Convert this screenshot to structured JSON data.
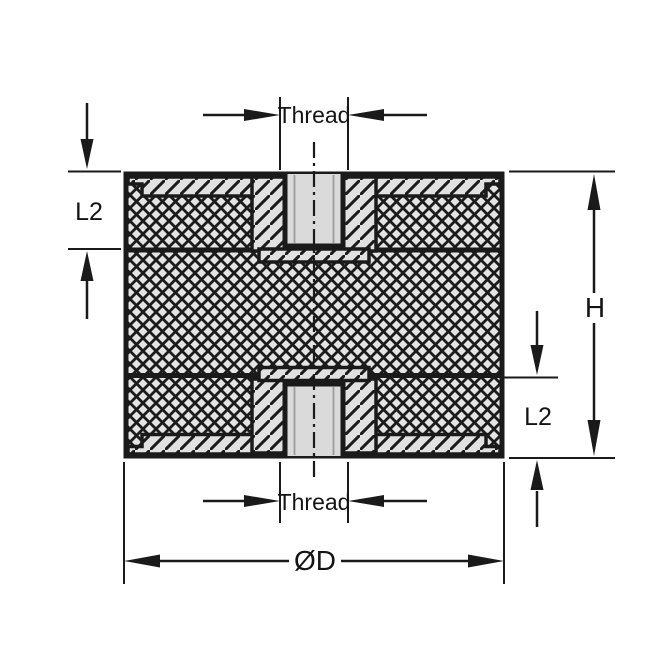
{
  "diagram": {
    "type": "technical-drawing-cross-section",
    "dimensions": [
      {
        "id": "thread-top",
        "label": "Thread"
      },
      {
        "id": "l2-left",
        "label": "L2"
      },
      {
        "id": "height-right",
        "label": "H"
      },
      {
        "id": "l2-right",
        "label": "L2"
      },
      {
        "id": "thread-bottom",
        "label": "Thread"
      },
      {
        "id": "diameter",
        "label": "ØD"
      }
    ],
    "colors": {
      "line": "#1a1a1a",
      "rubber_fill": "#e4e4e4",
      "metal_fill": "#e1e1e1",
      "hole_fill": "#dadada",
      "background": "#ffffff"
    }
  }
}
